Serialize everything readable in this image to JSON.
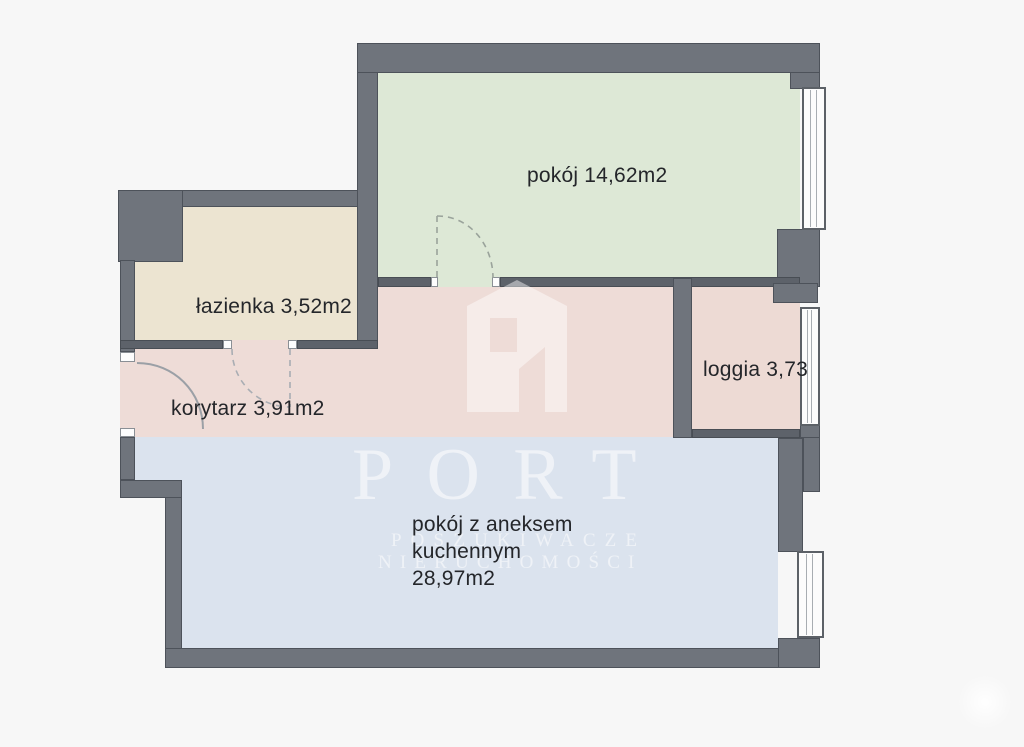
{
  "plan": {
    "background_color": "#f7f7f7",
    "wall_color": "#6f747c",
    "interior_wall_color": "#5d626a",
    "rooms": {
      "pokoj": {
        "label": "pokój 14,62m2",
        "color": "#dde8d6"
      },
      "lazienka": {
        "label": "łazienka 3,52m2",
        "color": "#ece4d1"
      },
      "korytarz": {
        "label": "korytarz 3,91m2",
        "color": "#eedcd7"
      },
      "loggia": {
        "label": "loggia 3,73",
        "color": "#eddad4"
      },
      "aneks": {
        "lines": [
          "pokój z aneksem",
          "kuchennym",
          "28,97m2"
        ],
        "color": "#dbe3ee"
      }
    }
  },
  "watermark": {
    "brand": "PORT",
    "subtitle_line1": "POSZUKIWACZE",
    "subtitle_line2": "NIERUCHOMOŚCI",
    "logo_icon": "port-building-logo"
  }
}
